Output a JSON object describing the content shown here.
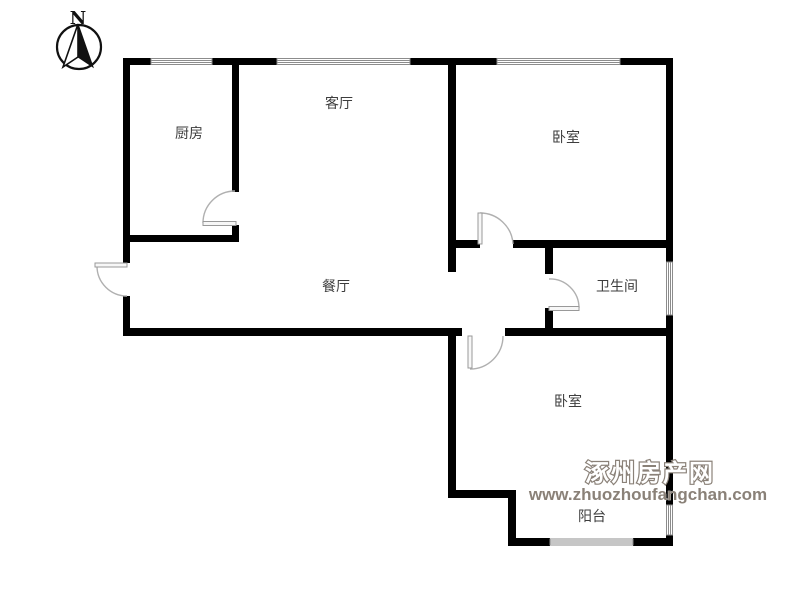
{
  "compass": {
    "label": "N"
  },
  "rooms": {
    "kitchen": "厨房",
    "living": "客厅",
    "bedroom_top": "卧室",
    "dining": "餐厅",
    "bathroom": "卫生间",
    "bedroom_bottom": "卧室",
    "balcony": "阳台"
  },
  "watermark": {
    "site_name": "涿州房产网",
    "site_url": "www.zhuozhoufangchan.com"
  },
  "colors": {
    "wall": "#000000",
    "window_line": "#8c8c8c",
    "door_arc": "#b0b0b0",
    "label_text": "#3d3d3d",
    "watermark": "#8a8178"
  }
}
